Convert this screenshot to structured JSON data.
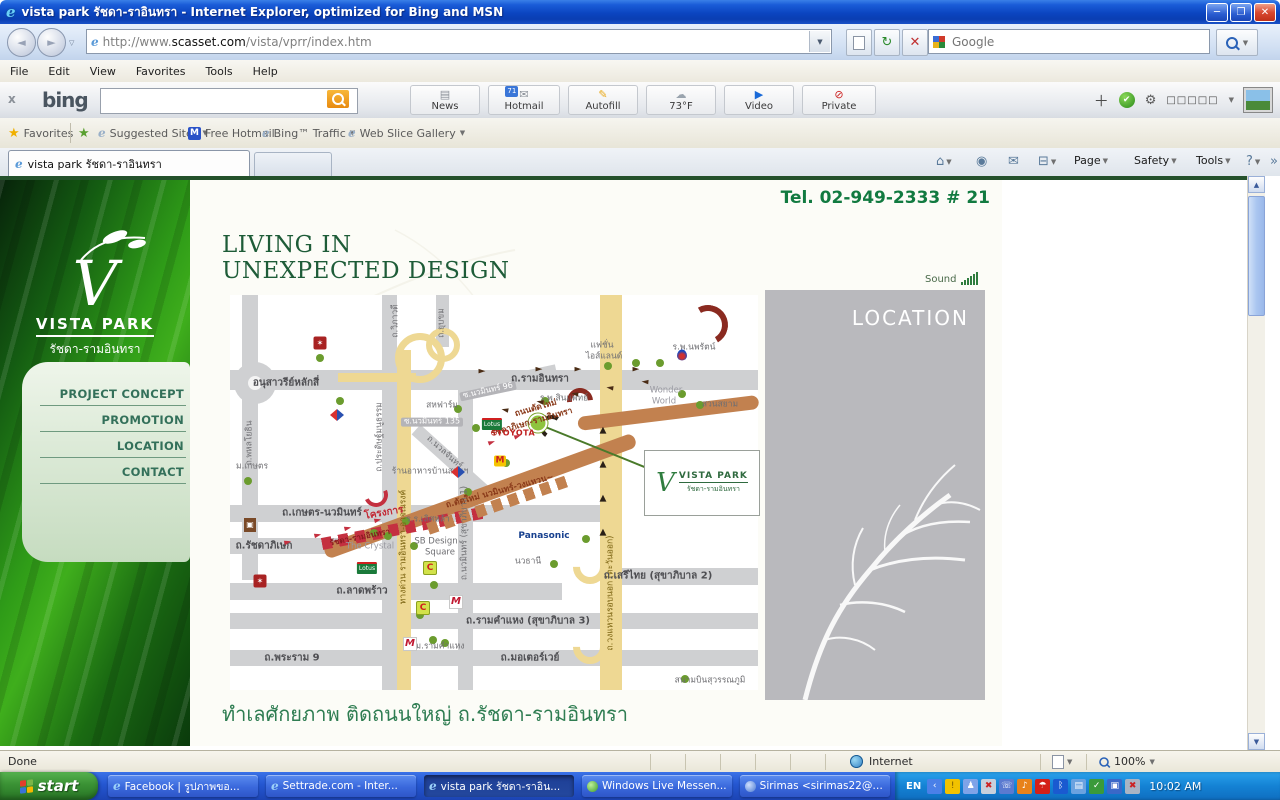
{
  "titlebar": {
    "title": "vista park รัชดา-ราอินทรา - Internet Explorer, optimized for Bing and MSN"
  },
  "addressbar": {
    "url_prefix": "http://www.",
    "url_domain": "scasset.com",
    "url_path": "/vista/vprr/index.htm",
    "google_placeholder": "Google"
  },
  "menubar": {
    "items": [
      "File",
      "Edit",
      "View",
      "Favorites",
      "Tools",
      "Help"
    ]
  },
  "bingbar": {
    "logo": "bing",
    "buttons": [
      {
        "label": "News",
        "glyph": "▤",
        "color": "#8a9098",
        "x": 410,
        "w": 70
      },
      {
        "label": "Hotmail",
        "glyph": "✉",
        "color": "#8a9098",
        "x": 488,
        "w": 72,
        "badge": "71"
      },
      {
        "label": "Autofill",
        "glyph": "✎",
        "color": "#e8a818",
        "x": 568,
        "w": 70
      },
      {
        "label": "73°F",
        "glyph": "☁",
        "color": "#9aa4ae",
        "x": 646,
        "w": 70
      },
      {
        "label": "Video",
        "glyph": "▶",
        "color": "#1a6ad8",
        "x": 724,
        "w": 70
      },
      {
        "label": "Private",
        "glyph": "⊘",
        "color": "#cc2020",
        "x": 802,
        "w": 74
      }
    ],
    "overflow_boxes": "□□□□□"
  },
  "favbar": {
    "favorites_label": "Favorites",
    "items": [
      {
        "label": "Suggested Sites",
        "icon": "ie",
        "caret": true,
        "x": 98
      },
      {
        "label": "Free Hotmail",
        "icon": "m",
        "caret": false,
        "x": 188
      },
      {
        "label": "Bing™ Traffic",
        "icon": "ie",
        "caret": true,
        "x": 262
      },
      {
        "label": "Web Slice Gallery",
        "icon": "ie",
        "caret": true,
        "x": 348
      }
    ]
  },
  "tabs": {
    "active": "vista park รัชดา-ราอินทรา"
  },
  "commandbar": {
    "items": [
      {
        "icon": "home",
        "glyph": "⌂",
        "caret": true,
        "x": 936
      },
      {
        "icon": "feed",
        "glyph": "◉",
        "caret": false,
        "x": 976
      },
      {
        "icon": "mail",
        "glyph": "✉",
        "caret": false,
        "x": 1008
      },
      {
        "icon": "print",
        "glyph": "⊟",
        "caret": true,
        "x": 1038
      },
      {
        "label": "Page",
        "caret": true,
        "x": 1074
      },
      {
        "label": "Safety",
        "caret": true,
        "x": 1134
      },
      {
        "label": "Tools",
        "caret": true,
        "x": 1196
      },
      {
        "icon": "help",
        "glyph": "?",
        "caret": true,
        "x": 1246
      },
      {
        "icon": "more",
        "glyph": "»",
        "caret": false,
        "x": 1270
      }
    ]
  },
  "content": {
    "tel": "Tel. 02-949-2333 # 21",
    "headline1": "LIVING IN",
    "headline2": "UNEXPECTED DESIGN",
    "sound": "Sound",
    "location_title": "LOCATION",
    "bottom_heading": "ทำเลศักยภาพ ติดถนนใหญ่ ถ.รัชดา-รามอินทรา",
    "sidebar": {
      "brand": "VISTA PARK",
      "brand_sub": "รัชดา-รามอินทรา",
      "menu": [
        "PROJECT CONCEPT",
        "PROMOTION",
        "LOCATION",
        "CONTACT"
      ]
    },
    "map": {
      "roundabout": {
        "x": 25,
        "y": 88,
        "d": 42
      },
      "roads": [
        {
          "x": 0,
          "y": 75,
          "w": 528,
          "h": 20
        },
        {
          "x": 0,
          "y": 210,
          "w": 392,
          "h": 17
        },
        {
          "x": 0,
          "y": 243,
          "w": 112,
          "h": 16
        },
        {
          "x": 0,
          "y": 288,
          "w": 332,
          "h": 17
        },
        {
          "x": 382,
          "y": 273,
          "w": 146,
          "h": 17
        },
        {
          "x": 0,
          "y": 318,
          "w": 528,
          "h": 16
        },
        {
          "x": 0,
          "y": 355,
          "w": 528,
          "h": 16
        },
        {
          "x": 12,
          "y": 0,
          "w": 16,
          "h": 285
        },
        {
          "x": 152,
          "y": 0,
          "w": 15,
          "h": 395
        },
        {
          "x": 206,
          "y": 0,
          "w": 13,
          "h": 52
        },
        {
          "x": 228,
          "y": 88,
          "w": 15,
          "h": 307
        },
        {
          "x": 186,
          "y": 128,
          "w": 95,
          "h": 13,
          "rot": 42
        },
        {
          "x": 238,
          "y": 88,
          "w": 90,
          "h": 11,
          "rot": -12
        },
        {
          "x": 370,
          "y": 0,
          "w": 22,
          "h": 395,
          "c": "#eed893"
        },
        {
          "x": 167,
          "y": 55,
          "w": 14,
          "h": 340,
          "c": "#eed893"
        },
        {
          "x": 108,
          "y": 78,
          "w": 78,
          "h": 9,
          "c": "#eed893"
        }
      ],
      "browns": [
        {
          "x": 95,
          "y": 250,
          "w": 330,
          "h": 15,
          "rot": -20
        },
        {
          "x": 348,
          "y": 122,
          "w": 182,
          "h": 14,
          "rot": -7
        }
      ],
      "dashes": [
        {
          "x": 92,
          "y": 243,
          "w": 168,
          "h": 12,
          "rot": -11,
          "c": "#c43040"
        },
        {
          "x": 198,
          "y": 228,
          "w": 152,
          "h": 12,
          "rot": -19,
          "c": "#c2814f"
        }
      ],
      "arcs": [
        {
          "x": 478,
          "y": 30,
          "d": 40,
          "rot": 15,
          "c": "#8a2a20",
          "t": 6
        },
        {
          "x": 350,
          "y": 106,
          "d": 26,
          "rot": -50,
          "c": "#8a2a20",
          "t": 5
        },
        {
          "x": 322,
          "y": 132,
          "d": 24,
          "rot": -100,
          "c": "#2a2017",
          "t": 4
        },
        {
          "x": 146,
          "y": 200,
          "d": 24,
          "rot": 110,
          "c": "#c43040",
          "t": 4
        },
        {
          "x": 360,
          "y": 272,
          "d": 34,
          "rot": 135,
          "c": "#eed893",
          "t": 7
        },
        {
          "x": 360,
          "y": 352,
          "d": 34,
          "rot": 135,
          "c": "#eed893",
          "t": 7
        },
        {
          "x": 190,
          "y": 63,
          "d": 50,
          "rot": 0,
          "c": "#eed893",
          "t": 7,
          "full": 1
        },
        {
          "x": 213,
          "y": 50,
          "d": 34,
          "rot": 0,
          "c": "#eed893",
          "t": 6,
          "full": 1
        }
      ],
      "labels": [
        {
          "t": "อนุสาวรีย์หลักสี่",
          "x": 56,
          "y": 88,
          "cls": "rl"
        },
        {
          "t": "ถ.รามอินทรา",
          "x": 310,
          "y": 84,
          "cls": "rl"
        },
        {
          "t": "ถ.พหลโยธิน",
          "x": 20,
          "y": 148,
          "cls": "sm",
          "rot": -90
        },
        {
          "t": "ม.เกษตร",
          "x": 22,
          "y": 172,
          "cls": "sm"
        },
        {
          "t": "ถ.วิภาวดี",
          "x": 166,
          "y": 26,
          "cls": "sm",
          "rot": -90
        },
        {
          "t": "ถ.ยุบขม",
          "x": 212,
          "y": 28,
          "cls": "sm",
          "rot": -90
        },
        {
          "t": "ถ.ประดิษฐ์มนูธรรม",
          "x": 150,
          "y": 142,
          "cls": "sm",
          "rot": -90
        },
        {
          "t": "ทางด่วน รามอินทรา-อาจณรงค์",
          "x": 174,
          "y": 252,
          "cls": "ylab",
          "rot": -90
        },
        {
          "t": "ถ.นวมินทร์ (สุขาภิบาล 1)",
          "x": 235,
          "y": 238,
          "cls": "sm",
          "rot": -90
        },
        {
          "t": "ถ.วงแหวนรอบนอก (ตะวันออก)",
          "x": 381,
          "y": 298,
          "cls": "ylab",
          "rot": -90
        },
        {
          "t": "ถ.เกษตร-นวมินทร์",
          "x": 92,
          "y": 218,
          "cls": "rl"
        },
        {
          "t": "ถ.รัชดาภิเษก",
          "x": 34,
          "y": 251,
          "cls": "rl"
        },
        {
          "t": "ถ.ลาดพร้าว",
          "x": 132,
          "y": 296,
          "cls": "rl"
        },
        {
          "t": "ถ.พระราม 9",
          "x": 62,
          "y": 363,
          "cls": "rl"
        },
        {
          "t": "ถ.มอเตอร์เวย์",
          "x": 300,
          "y": 363,
          "cls": "rl"
        },
        {
          "t": "ถ.เสรีไทย (สุขาภิบาล 2)",
          "x": 428,
          "y": 281,
          "cls": "rl"
        },
        {
          "t": "ถ.รามคำแหง (สุขาภิบาล 3)",
          "x": 298,
          "y": 326,
          "cls": "rl"
        },
        {
          "t": "สหฟาร์ม",
          "x": 212,
          "y": 111,
          "cls": "sm"
        },
        {
          "t": "ซ.นวมินทร์ 135",
          "x": 202,
          "y": 127,
          "cls": "chip"
        },
        {
          "t": "ซ.นวมินทร์ 96",
          "x": 258,
          "y": 96,
          "cls": "chip",
          "rot": -12
        },
        {
          "t": "ถ.นวลจันทร์",
          "x": 214,
          "y": 158,
          "cls": "sm",
          "rot": 42
        },
        {
          "t": "ร้านอาหารบ้านสวนฯ",
          "x": 200,
          "y": 177,
          "cls": "sm"
        },
        {
          "t": "แฟชั่น",
          "x": 372,
          "y": 51,
          "cls": "sm"
        },
        {
          "t": "ไอส์แลนด์",
          "x": 374,
          "y": 62,
          "cls": "sm"
        },
        {
          "t": "ร.พ.นพรัตน์",
          "x": 464,
          "y": 53,
          "cls": "sm"
        },
        {
          "t": "ร.พ.สินแพทย์",
          "x": 334,
          "y": 104,
          "cls": "sm"
        },
        {
          "t": "Wonder",
          "x": 436,
          "y": 96,
          "cls": "smg"
        },
        {
          "t": "World",
          "x": 434,
          "y": 107,
          "cls": "smg"
        },
        {
          "t": "สวนสยาม",
          "x": 490,
          "y": 110,
          "cls": "sm"
        },
        {
          "t": "Panasonic",
          "x": 314,
          "y": 242,
          "cls": "blue"
        },
        {
          "t": "นวธานี",
          "x": 298,
          "y": 267,
          "cls": "sm"
        },
        {
          "t": "ร.ร.เลิศหล้า",
          "x": 198,
          "y": 225,
          "cls": "sm"
        },
        {
          "t": "SB Design",
          "x": 206,
          "y": 247,
          "cls": "sm"
        },
        {
          "t": "Square",
          "x": 210,
          "y": 258,
          "cls": "sm"
        },
        {
          "t": "The Crystal",
          "x": 140,
          "y": 252,
          "cls": "smg"
        },
        {
          "t": "โครงการ",
          "x": 154,
          "y": 218,
          "cls": "red",
          "rot": -10
        },
        {
          "t": "รัชดา-รามอินทรา",
          "x": 130,
          "y": 243,
          "cls": "redsm",
          "rot": -11
        },
        {
          "t": "ถ.ตัดใหม่ นวมินทร์-วงแหวน~",
          "x": 270,
          "y": 197,
          "cls": "redbr",
          "rot": -15
        },
        {
          "t": "ถนนตัดใหม่",
          "x": 306,
          "y": 114,
          "cls": "redbr",
          "rot": -16
        },
        {
          "t": "รัชดาภิเษก-รามอินทรา",
          "x": 302,
          "y": 128,
          "cls": "redbr",
          "rot": -16
        },
        {
          "t": "TOYOTA",
          "x": 286,
          "y": 139,
          "cls": "toyota"
        },
        {
          "t": "ม.รามคำแหง",
          "x": 210,
          "y": 352,
          "cls": "sm"
        },
        {
          "t": "สนามบินสุวรรณภูมิ",
          "x": 480,
          "y": 386,
          "cls": "sm"
        }
      ],
      "dots": [
        [
          90,
          63
        ],
        [
          110,
          106
        ],
        [
          18,
          186
        ],
        [
          228,
          114
        ],
        [
          315,
          106
        ],
        [
          378,
          71
        ],
        [
          406,
          68
        ],
        [
          430,
          68
        ],
        [
          470,
          110
        ],
        [
          452,
          99
        ],
        [
          356,
          244
        ],
        [
          324,
          269
        ],
        [
          276,
          168
        ],
        [
          238,
          197
        ],
        [
          176,
          226
        ],
        [
          184,
          251
        ],
        [
          204,
          290
        ],
        [
          190,
          320
        ],
        [
          215,
          348
        ],
        [
          455,
          384
        ],
        [
          144,
          238
        ],
        [
          158,
          241
        ],
        [
          246,
          133
        ],
        [
          203,
          345
        ]
      ],
      "project_dot": {
        "x": 308,
        "y": 128
      },
      "pointer": {
        "x": 308,
        "y": 128,
        "w": 116,
        "rot": 22
      },
      "arrows": [
        {
          "g": "►",
          "x": 252,
          "y": 77,
          "c": "#4a2c15"
        },
        {
          "g": "►",
          "x": 309,
          "y": 75,
          "c": "#4a2c15"
        },
        {
          "g": "►",
          "x": 348,
          "y": 75,
          "c": "#4a2c15"
        },
        {
          "g": "►",
          "x": 406,
          "y": 75,
          "c": "#4a2c15"
        },
        {
          "g": "►",
          "x": 275,
          "y": 114,
          "rot": 192,
          "c": "#4a2c15"
        },
        {
          "g": "►",
          "x": 310,
          "y": 106,
          "rot": 190,
          "c": "#4a2c15"
        },
        {
          "g": "►",
          "x": 345,
          "y": 98,
          "rot": 190,
          "c": "#4a2c15"
        },
        {
          "g": "►",
          "x": 380,
          "y": 92,
          "rot": 188,
          "c": "#4a2c15"
        },
        {
          "g": "►",
          "x": 415,
          "y": 86,
          "rot": 185,
          "c": "#4a2c15"
        },
        {
          "g": "▲",
          "x": 373,
          "y": 136,
          "c": "#2a2017"
        },
        {
          "g": "▲",
          "x": 373,
          "y": 170,
          "c": "#2a2017"
        },
        {
          "g": "▲",
          "x": 373,
          "y": 204,
          "c": "#2a2017"
        },
        {
          "g": "▲",
          "x": 373,
          "y": 238,
          "c": "#2a2017"
        },
        {
          "g": "►",
          "x": 58,
          "y": 248,
          "rot": -14,
          "c": "#c43040"
        },
        {
          "g": "►",
          "x": 88,
          "y": 241,
          "rot": -14,
          "c": "#c43040"
        },
        {
          "g": "►",
          "x": 118,
          "y": 234,
          "rot": -14,
          "c": "#c43040"
        },
        {
          "g": "►",
          "x": 148,
          "y": 226,
          "rot": -14,
          "c": "#c43040"
        },
        {
          "g": "►",
          "x": 262,
          "y": 148,
          "rot": -20,
          "c": "#c43040"
        },
        {
          "g": "►",
          "x": 288,
          "y": 142,
          "rot": -20,
          "c": "#c43040"
        }
      ],
      "pois": [
        {
          "type": "market",
          "x": 90,
          "y": 48
        },
        {
          "type": "index",
          "x": 20,
          "y": 230
        },
        {
          "type": "market",
          "x": 30,
          "y": 286
        },
        {
          "type": "carrefour",
          "x": 107,
          "y": 120
        },
        {
          "type": "carrefour",
          "x": 228,
          "y": 177
        },
        {
          "type": "tesco",
          "x": 262,
          "y": 129
        },
        {
          "type": "tesco",
          "x": 137,
          "y": 273
        },
        {
          "type": "mcd",
          "x": 270,
          "y": 166
        },
        {
          "type": "bigc",
          "x": 200,
          "y": 273
        },
        {
          "type": "bigc",
          "x": 193,
          "y": 313
        },
        {
          "type": "mall",
          "x": 226,
          "y": 307
        },
        {
          "type": "mall",
          "x": 180,
          "y": 349
        },
        {
          "type": "ptt",
          "x": 452,
          "y": 60
        },
        {
          "type": "toyota",
          "x": 264,
          "y": 139
        }
      ],
      "poi_glyphs": {
        "market": "✶",
        "index": "▣",
        "carrefour": "",
        "tesco": "Lotus",
        "mcd": "M",
        "bigc": "C",
        "mall": "M",
        "ptt": "",
        "toyota": "⊕"
      },
      "logo_box": {
        "x": 414,
        "y": 155,
        "w": 114,
        "h": 64,
        "brand": "VISTA PARK",
        "sub": "รัชดา-รามอินทรา"
      }
    }
  },
  "statusbar": {
    "status": "Done",
    "zone": "Internet",
    "zoom": "100%"
  },
  "taskbar": {
    "start": "start",
    "tasks": [
      {
        "label": "Facebook | รูปภาพขอ...",
        "icon": "ie"
      },
      {
        "label": "Settrade.com - Inter...",
        "icon": "ie"
      },
      {
        "label": "vista park รัชดา-ราอิน...",
        "icon": "ie",
        "active": true
      },
      {
        "label": "Windows Live Messen...",
        "icon": "msn"
      },
      {
        "label": "Sirimas <sirimas22@h...",
        "icon": "usr"
      }
    ],
    "lang": "EN",
    "time": "10:02 AM",
    "tray_icons": [
      {
        "name": "hidden-icons-chevron",
        "bg": "#4a80e8",
        "glyph": "‹"
      },
      {
        "name": "security-alert-icon",
        "bg": "#f2c200",
        "glyph": "!",
        "fg": "#7a5a00"
      },
      {
        "name": "messenger-contact-icon",
        "bg": "#7fa3e8",
        "glyph": "♟"
      },
      {
        "name": "network-error-icon",
        "bg": "#c8d0dc",
        "glyph": "✖",
        "fg": "#cc2222"
      },
      {
        "name": "mobile-sync-icon",
        "bg": "#5a7ad0",
        "glyph": "☏"
      },
      {
        "name": "volume-icon",
        "bg": "#e8821a",
        "glyph": "♪"
      },
      {
        "name": "avira-icon",
        "bg": "#d42018",
        "glyph": "☂"
      },
      {
        "name": "bluetooth-icon",
        "bg": "#1a5ad0",
        "glyph": "ᛒ"
      },
      {
        "name": "chat-icon",
        "bg": "#6aa2e0",
        "glyph": "▤"
      },
      {
        "name": "updater-icon",
        "bg": "#3a9a3a",
        "glyph": "✓"
      },
      {
        "name": "display-icon",
        "bg": "#3a68c8",
        "glyph": "▣"
      },
      {
        "name": "wireless-error-icon",
        "bg": "#aab4c4",
        "glyph": "✖",
        "fg": "#cc2222"
      }
    ]
  }
}
